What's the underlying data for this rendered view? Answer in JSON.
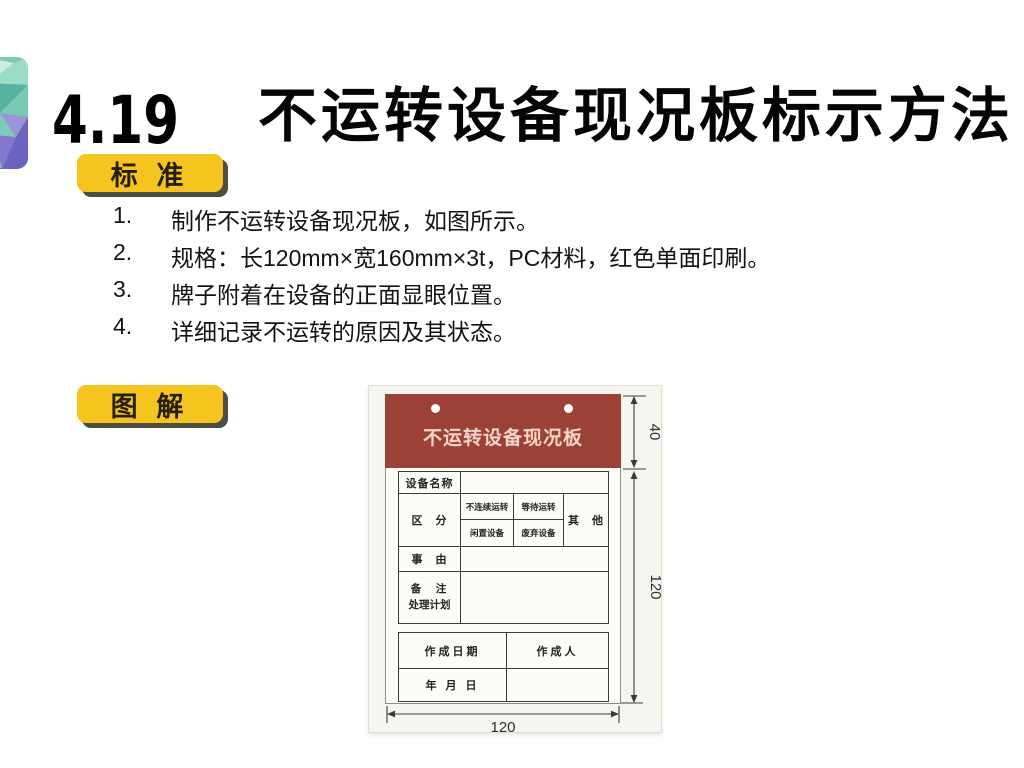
{
  "header": {
    "section_number": "4.19",
    "title": "不运转设备现况板标示方法"
  },
  "standard_section": {
    "badge_label": "标 准",
    "items": [
      {
        "num": "1.",
        "text": "制作不运转设备现况板，如图所示。"
      },
      {
        "num": "2.",
        "text": "规格：长120mm×宽160mm×3t，PC材料，红色单面印刷。"
      },
      {
        "num": "3.",
        "text": "牌子附着在设备的正面显眼位置。"
      },
      {
        "num": "4.",
        "text": "详细记录不运转的原因及其状态。"
      }
    ]
  },
  "diagram_section": {
    "badge_label": "图 解"
  },
  "placard": {
    "header_title": "不运转设备现况板",
    "colors": {
      "header_red": "#9c4136",
      "badge_yellow": "#f5c41e",
      "photo_background": "#f7f5ef"
    },
    "table": {
      "equipment_name_label": "设备名称",
      "category_label": "区　分",
      "category_options": [
        "不连续运转",
        "等待运转",
        "闲置设备",
        "废弃设备"
      ],
      "other_label": "其　他",
      "reason_label": "事　由",
      "remark_label": "备　注",
      "plan_label": "处理计划"
    },
    "footer": {
      "date_label": "作成日期",
      "author_label": "作成人",
      "ymd_label": "年 月 日"
    },
    "dims": {
      "header_height": "40",
      "body_height": "120",
      "width": "120"
    }
  }
}
